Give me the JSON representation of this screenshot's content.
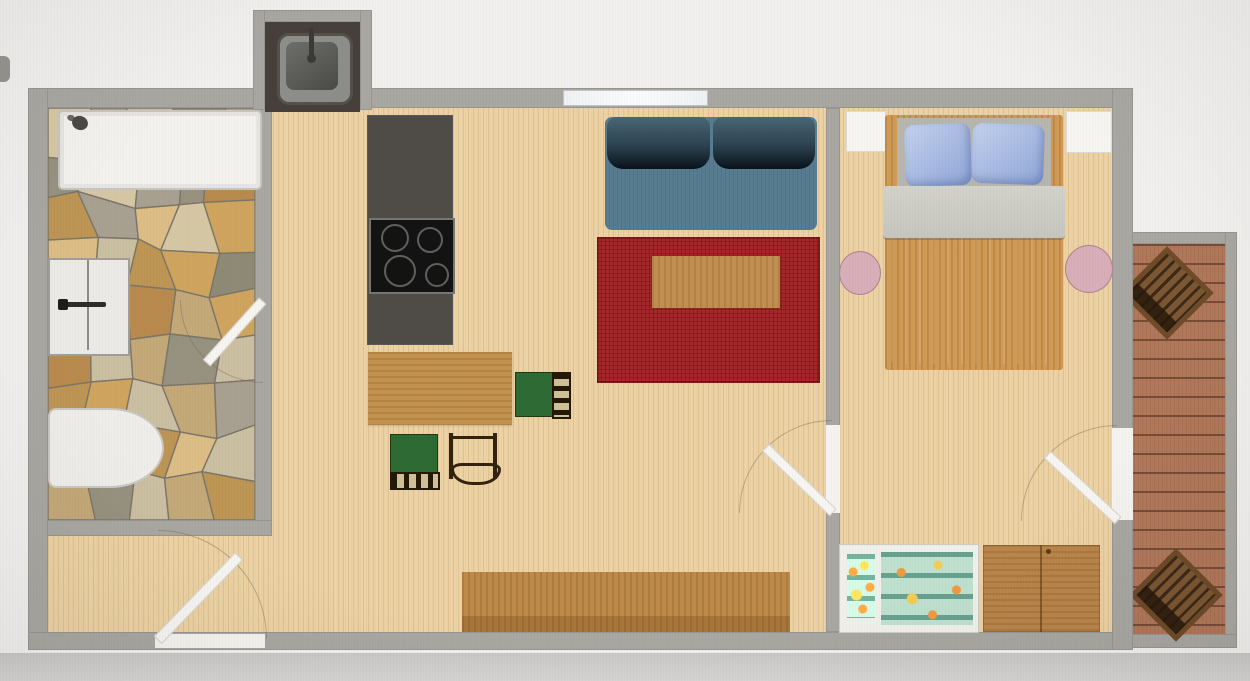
{
  "meta": {
    "kind": "apartment-floor-plan-photo",
    "visible_text": ""
  },
  "palette": {
    "photo_bg": "#f1f0ee",
    "photo_band": "#d8d6d4",
    "wall": "#a9a7a2",
    "floor": "#ecd2a4",
    "deck_floor": "#b2785a",
    "deck_chair": "#6f4b29",
    "stone_base": "#b7ab92",
    "sink_counter": "#473f39",
    "sink_basin": "#8d8d89",
    "tub": "#f3f2ee",
    "cabinet": "#eceae6",
    "toilet": "#eeede9",
    "counter": "#4f4b47",
    "cooktop": "#131313",
    "dining_table": "#c3924e",
    "chair_seat": "#2e6a33",
    "chair_wood": "#2a1c0c",
    "sofa": "#587c90",
    "rug": "#a7272b",
    "coffee_table": "#c28f50",
    "sideboard": "#bd8a4a",
    "bed_frame": "#d09a55",
    "mattress_head": "#b6b6ae",
    "blanket": "#c6c6be",
    "duvet": "#a3b9dc",
    "side_table": "#d8aeb8",
    "kids_frame": "#f1efe9",
    "kids_bedding": "#bfe0cf",
    "dresser": "#b9854b",
    "door_leaf": "#f6f5f1"
  },
  "stone_colors": [
    "#d6c7a4",
    "#c3a878",
    "#bd9554",
    "#a8a090",
    "#cfa45e",
    "#97927f",
    "#dcbd85",
    "#b98a4e",
    "#cbbfa2",
    "#8e8a76"
  ],
  "rooms": [
    {
      "id": "bathroom",
      "features": [
        "bathtub",
        "shower-head",
        "cabinet",
        "toilet",
        "stone-floor"
      ]
    },
    {
      "id": "living-kitchen",
      "features": [
        "sink-alcove",
        "kitchen-counter",
        "cooktop",
        "dining-table",
        "three-chairs",
        "sofa",
        "red-rug",
        "coffee-table",
        "sideboard"
      ]
    },
    {
      "id": "bedroom",
      "features": [
        "double-bed",
        "two-pillows",
        "two-round-side-tables",
        "kids-bed",
        "dresser"
      ]
    },
    {
      "id": "deck",
      "features": [
        "plank-floor",
        "two-wooden-lounge-chairs"
      ]
    }
  ],
  "doors": [
    "entrance-bottom",
    "bathroom",
    "living-to-bedroom",
    "bedroom-to-deck"
  ],
  "windows": [
    "living-top",
    "bedroom-left-white-unit",
    "bedroom-right-white-unit"
  ]
}
